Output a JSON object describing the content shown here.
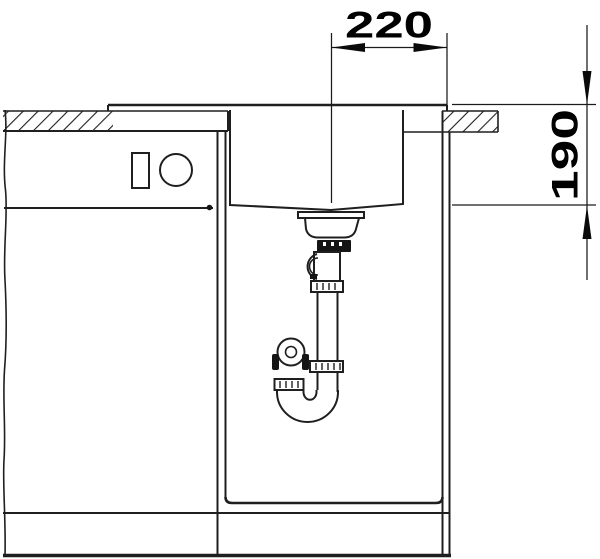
{
  "diagram": {
    "subject": "sink base cabinet cross-section with strainer and siphon",
    "dim_width": {
      "label": "220"
    },
    "dim_depth": {
      "label": "190"
    },
    "colors": {
      "line": "#1f1f1f",
      "dim": "#000000",
      "background": "#ffffff"
    }
  }
}
